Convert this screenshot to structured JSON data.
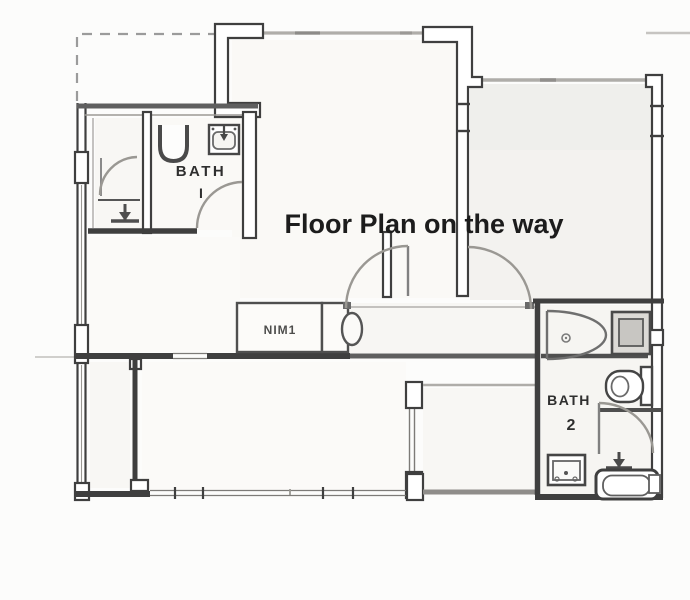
{
  "overlay": {
    "title": "Floor Plan on the way"
  },
  "labels": {
    "bath1": {
      "line1": "BATH",
      "line2": "I"
    },
    "bath2": {
      "line1": "BATH",
      "line2": "2"
    },
    "counter": "NIM1"
  },
  "colors": {
    "paper": "#fcfcfb",
    "wall_dark": "#3f3f3f",
    "wall_medium": "#5f5f5f",
    "wall_gray": "#afada9",
    "window_thin": "#7d7b78",
    "arc": "#9a9893",
    "fixture": "#4a4a4a",
    "text": "#1c1c1c",
    "room_fill": "#f6f5f2",
    "dashed": "#9b9b9b"
  }
}
